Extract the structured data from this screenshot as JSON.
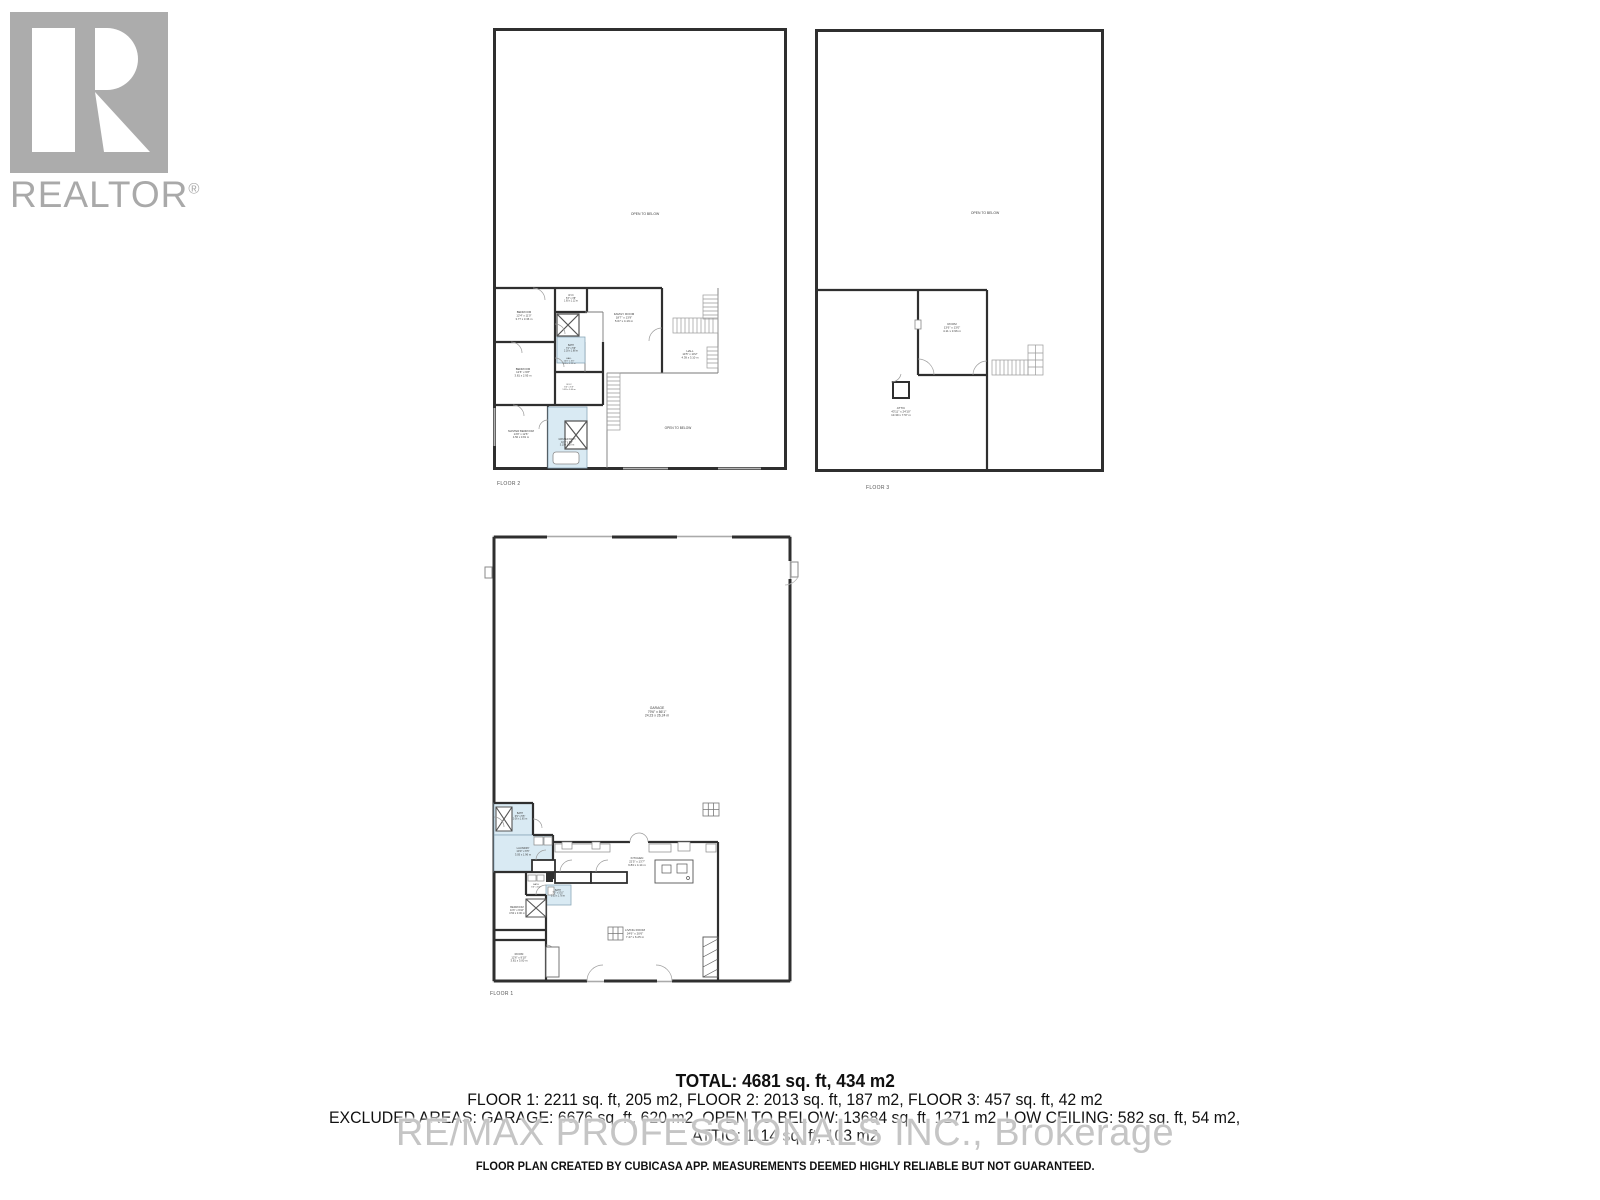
{
  "branding": {
    "realtor_wordmark": "REALTOR",
    "registered_mark": "®"
  },
  "watermark": {
    "text": "RE/MAX PROFESSIONALS INC., Brokerage"
  },
  "summary": {
    "total": "TOTAL: 4681 sq. ft, 434 m2",
    "floors": "FLOOR 1: 2211 sq. ft, 205 m2, FLOOR 2: 2013 sq. ft, 187 m2, FLOOR 3: 457 sq. ft, 42 m2",
    "excluded": "EXCLUDED AREAS: GARAGE: 6676 sq. ft, 620 m2, OPEN TO BELOW: 13684 sq. ft, 1271 m2, LOW CEILING: 582 sq. ft, 54 m2,",
    "attic": "ATTIC: 1114 sq. ft, 103 m2",
    "disclaimer": "FLOOR PLAN CREATED BY CUBICASA APP. MEASUREMENTS DEEMED HIGHLY RELIABLE BUT NOT GUARANTEED."
  },
  "colors": {
    "wall": "#2f2f2f",
    "wet_room_fill": "#d9eaf3",
    "watermark_gray": "#c5c5c5",
    "logo_gray": "#a9a9a9"
  },
  "plans": {
    "floor2": {
      "caption": "FLOOR 2",
      "rooms": {
        "open_below_top": {
          "name": "OPEN TO BELOW"
        },
        "open_below_bottom": {
          "name": "OPEN TO BELOW"
        },
        "bedroom1": {
          "name": "BEDROOM",
          "dims_ft": "12'4\" x 11'0\"",
          "dims_m": "3.77 x 3.36 m"
        },
        "wic1": {
          "name": "W.I.C",
          "dims_ft": "5'3\" x 3'8\"",
          "dims_m": "1.60 x 1.12 m"
        },
        "bath1": {
          "name": "BATH",
          "dims_ft": "7'2\" x 5'6\"",
          "dims_m": "2.18 x 1.68 m"
        },
        "family_room": {
          "name": "FAMILY ROOM",
          "dims_ft": "18'7\" x 13'9\"",
          "dims_m": "5.67 x 4.19 m"
        },
        "hall_right": {
          "name": "HALL",
          "dims_ft": "14'5\" x 10'2\"",
          "dims_m": "4.39 x 3.10 m"
        },
        "bedroom2": {
          "name": "BEDROOM",
          "dims_ft": "12'6\" x 9'8\"",
          "dims_m": "3.81 x 2.95 m"
        },
        "hall_mid": {
          "name": "HALL",
          "dims_ft": "10'0\" x 4'0\"",
          "dims_m": "3.05 x 1.22 m"
        },
        "wic2": {
          "name": "W.I.C",
          "dims_ft": "6'0\" x 5'3\"",
          "dims_m": "1.83 x 1.60 m"
        },
        "master_bedroom": {
          "name": "MASTER BEDROOM",
          "dims_ft": "14'9\" x 12'6\"",
          "dims_m": "4.50 x 3.81 m"
        },
        "master_bath": {
          "name": "MASTER BATH",
          "dims_ft": "10'2\" x 8'6\"",
          "dims_m": "3.10 x 2.59 m"
        }
      }
    },
    "floor3": {
      "caption": "FLOOR 3",
      "rooms": {
        "open_below": {
          "name": "OPEN TO BELOW"
        },
        "room": {
          "name": "ROOM",
          "dims_ft": "13'6\" x 13'0\"",
          "dims_m": "4.11 x 3.96 m"
        },
        "attic": {
          "name": "ATTIC",
          "dims_ft": "43'11\" x 24'10\"",
          "dims_m": "13.39 x 7.57 m"
        }
      }
    },
    "floor1": {
      "caption": "FLOOR 1",
      "rooms": {
        "garage": {
          "name": "GARAGE",
          "dims_ft": "79'6\" x 86'1\"",
          "dims_m": "24.23 x 26.24 m"
        },
        "bath_a": {
          "name": "BATH",
          "dims_ft": "6'9\" x 5'5\"",
          "dims_m": "2.06 x 1.65 m"
        },
        "laundry": {
          "name": "LAUNDRY",
          "dims_ft": "10'0\" x 6'5\"",
          "dims_m": "3.05 x 1.96 m"
        },
        "kitchen": {
          "name": "KITCHEN",
          "dims_ft": "22'5\" x 13'7\"",
          "dims_m": "6.83 x 4.14 m"
        },
        "bath_b": {
          "name": "BATH",
          "dims_ft": "6'6\" x 5'0\"",
          "dims_m": "1.98 x 1.52 m"
        },
        "bath_c": {
          "name": "BATH",
          "dims_ft": "7'0\" x 5'10\"",
          "dims_m": "2.13 x 1.78 m"
        },
        "bedroom": {
          "name": "BEDROOM",
          "dims_ft": "11'6\" x 9'10\"",
          "dims_m": "3.50 x 3.00 m"
        },
        "room": {
          "name": "ROOM",
          "dims_ft": "12'6\" x 9'10\"",
          "dims_m": "3.81 x 3.00 m"
        },
        "living_room": {
          "name": "LIVING ROOM",
          "dims_ft": "24'6\" x 20'6\"",
          "dims_m": "7.47 x 6.25 m"
        }
      }
    }
  }
}
